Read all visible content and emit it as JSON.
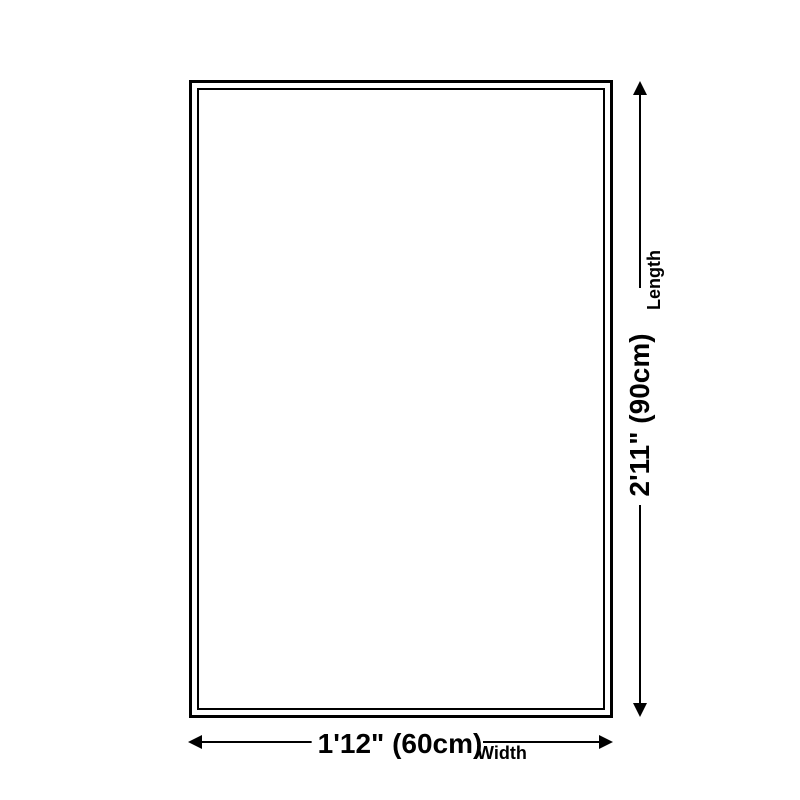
{
  "diagram": {
    "background_color": "#ffffff",
    "line_color": "#000000",
    "length_dimension": {
      "value": "2'11\" (90cm)",
      "label": "Length"
    },
    "width_dimension": {
      "value": "1'12\" (60cm)",
      "label": "Width"
    },
    "icons": {
      "arrow_up": "css-triangle-up",
      "arrow_down": "css-triangle-down",
      "arrow_left": "css-triangle-left",
      "arrow_right": "css-triangle-right"
    }
  }
}
